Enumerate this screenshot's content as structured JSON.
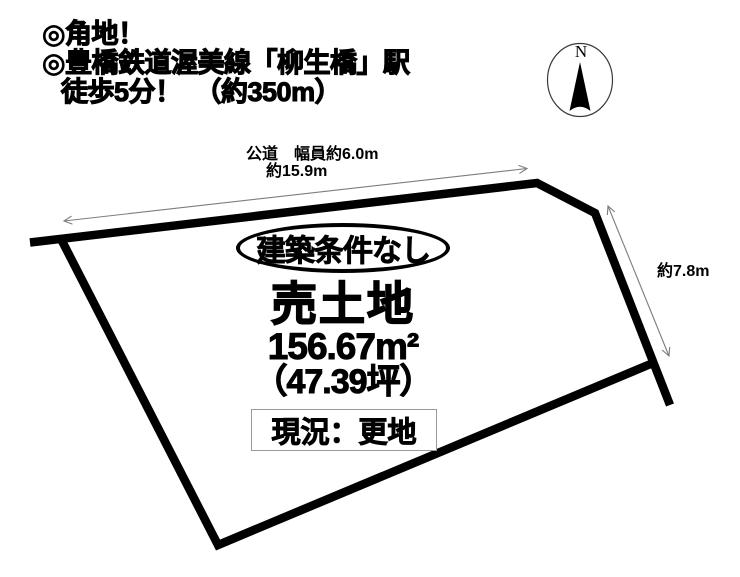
{
  "colors": {
    "ink": "#000000",
    "dimension_line": "#7d7d7d",
    "status_box_border": "#9a9a9a",
    "background": "#ffffff"
  },
  "header": {
    "line1": "◎角地！",
    "line2": "◎豊橋鉄道渥美線「柳生橋」駅",
    "line3": "徒歩5分！　（約350m）"
  },
  "compass": {
    "north": "N",
    "icon": "north-needle-icon"
  },
  "road": {
    "label": "公道　幅員約6.0m"
  },
  "dimensions": {
    "frontage": "約15.9m",
    "right_side": "約7.8m"
  },
  "parcel": {
    "condition": "建築条件なし",
    "title": "売土地",
    "area_sqm": "156.67m²",
    "area_tsubo": "（47.39坪）",
    "status": "現況：更地"
  }
}
